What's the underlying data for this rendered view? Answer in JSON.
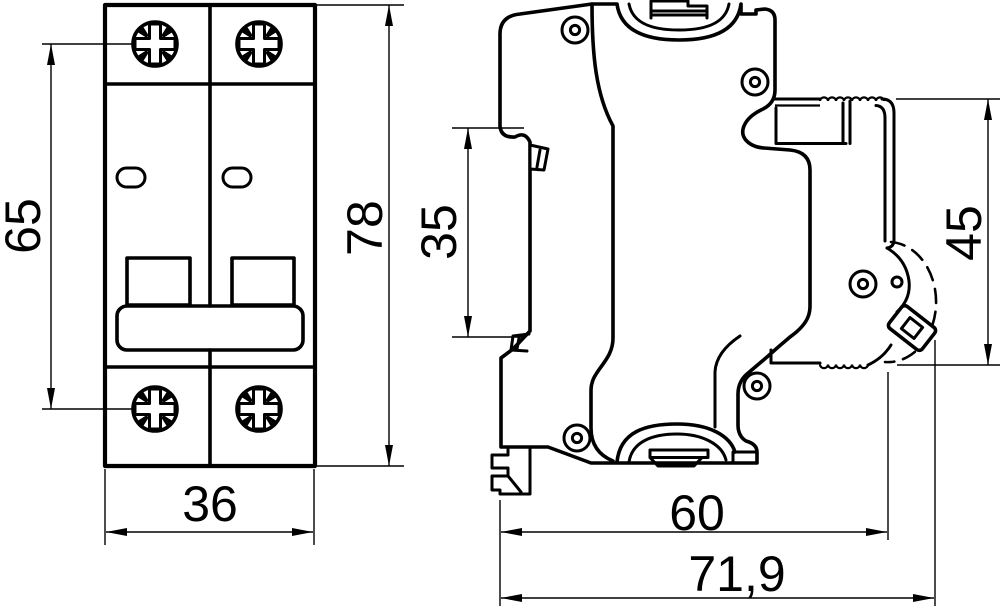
{
  "drawing": {
    "type": "technical-dimension-drawing",
    "subject": "2-pole modular circuit breaker, front and side views",
    "colors": {
      "ink": "#000000",
      "paper": "#ffffff"
    },
    "front_view": {
      "mounting_centers": "65",
      "overall_height": "78",
      "overall_width": "36"
    },
    "side_view": {
      "din_rail_width": "35",
      "front_depth": "45",
      "body_depth": "60",
      "overall_depth": "71,9"
    }
  }
}
